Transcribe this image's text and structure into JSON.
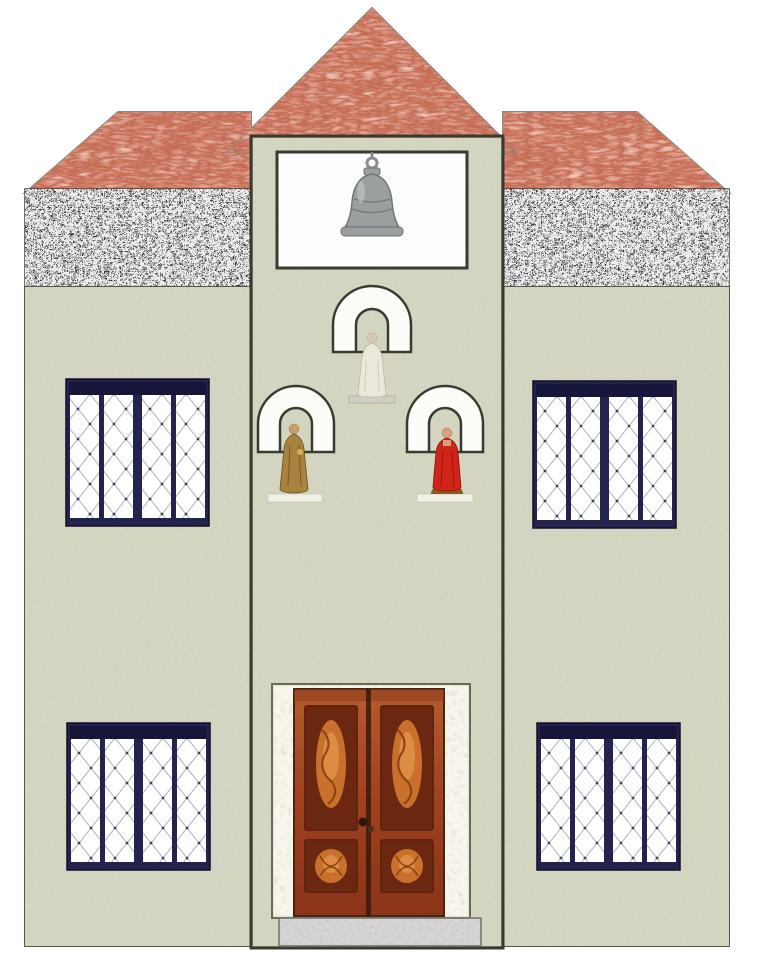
{
  "scene": {
    "type": "illustration",
    "description": "Stylized collage of a church facade: central bell tower with triangular red roof and hanging bell, red mottled wing roofs over a black-and-white granite band, olive stucco walls, three arched niches holding statues, four navy lattice windows, a carved wooden double door with stone surround and a granite entrance step",
    "background": "#ffffff"
  },
  "colors": {
    "wall": "#9b9d7e",
    "roof_base": "#8a1a0c",
    "granite_base": "#8a8a8a",
    "outline": "#55554a",
    "tower_outline": "#3a3a30",
    "bell_opening_bg": "#fdfdfb",
    "bell_metal": "#9aa0a0",
    "bell_metal_dark": "#6f7575",
    "niche_white": "#fcfcf8",
    "window_frame": "#23234d",
    "window_header": "#16163a",
    "window_pane": "#ffffff",
    "lattice_line": "#a8aec0",
    "lattice_dot": "#3f4558",
    "door_surround": "#e9e6d0",
    "door_wood_dark_panel": "#6b2710",
    "door_panel_border": "#5f2410",
    "door_carving": "#c9702c",
    "door_carving_light": "#e09048",
    "door_handle": "#2a1a0e",
    "step": "#a3a3a3",
    "statue_center_robe": "#ece8dc",
    "statue_center_head": "#d8c8b0",
    "statue_left_robe": "#a8833f",
    "statue_left_accent": "#d8b050",
    "statue_right_robe": "#cf2518",
    "statue_right_skin": "#d8a080",
    "statue_right_base": "#8a5a28",
    "pedestal": "#f0f0e6",
    "pedestal_center": "#cfcfc3"
  },
  "components": {
    "pediment": "triangular red tower roof",
    "left_roof": "left wing sloped red roof",
    "right_roof": "right wing sloped red roof",
    "granite_band": "black and white granite masonry band",
    "bell": "gray church bell hanging in white opening",
    "niche_top": "arched niche with white-robed statue",
    "niche_left": "arched niche with tan-robed statue",
    "niche_right": "arched niche with red-robed statue",
    "windows": [
      "upper-left",
      "upper-right",
      "lower-left",
      "lower-right"
    ],
    "door": "carved mahogany double door",
    "step": "granite entrance step"
  }
}
